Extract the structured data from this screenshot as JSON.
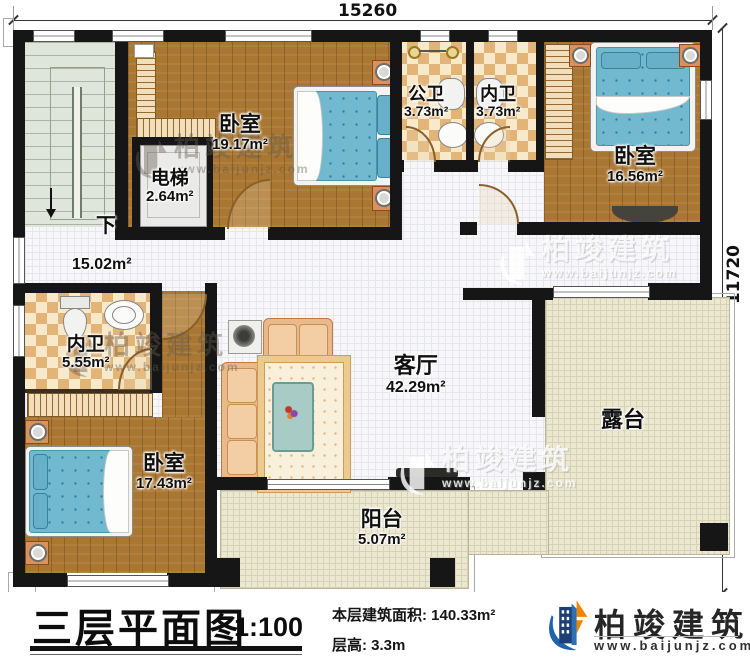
{
  "dims": {
    "top": "15260",
    "right": "11720"
  },
  "stairs": {
    "down": "下"
  },
  "rooms": {
    "bedroom_tl": {
      "name": "卧室",
      "area": "19.17m²"
    },
    "elevator": {
      "name": "电梯",
      "area": "2.64m²"
    },
    "public_bath": {
      "name": "公卫",
      "area": "3.73m²"
    },
    "inner_bath_top": {
      "name": "内卫",
      "area": "3.73m²"
    },
    "bedroom_tr": {
      "name": "卧室",
      "area": "16.56m²"
    },
    "hall": {
      "area": "15.02m²"
    },
    "inner_bath_left": {
      "name": "内卫",
      "area": "5.55m²"
    },
    "bedroom_bl": {
      "name": "卧室",
      "area": "17.43m²"
    },
    "living": {
      "name": "客厅",
      "area": "42.29m²"
    },
    "terrace": {
      "name": "露台"
    },
    "balcony": {
      "name": "阳台",
      "area": "5.07m²"
    }
  },
  "watermark": {
    "name": "柏竣建筑",
    "site": "www.baijunjz.com"
  },
  "footer": {
    "title": "三层平面图",
    "scale": "1:100",
    "area_label": "本层建筑面积: 140.33m²",
    "floor_height": "层高: 3.3m"
  },
  "brand": {
    "name": "柏竣建筑",
    "site": "www.baijunjz.com"
  },
  "colors": {
    "wall": "#161616",
    "brand_blue": "#1f63ad",
    "brand_navy": "#1d3f73",
    "accent_orange": "#f08300",
    "bed_blue": "#72b8cf"
  }
}
